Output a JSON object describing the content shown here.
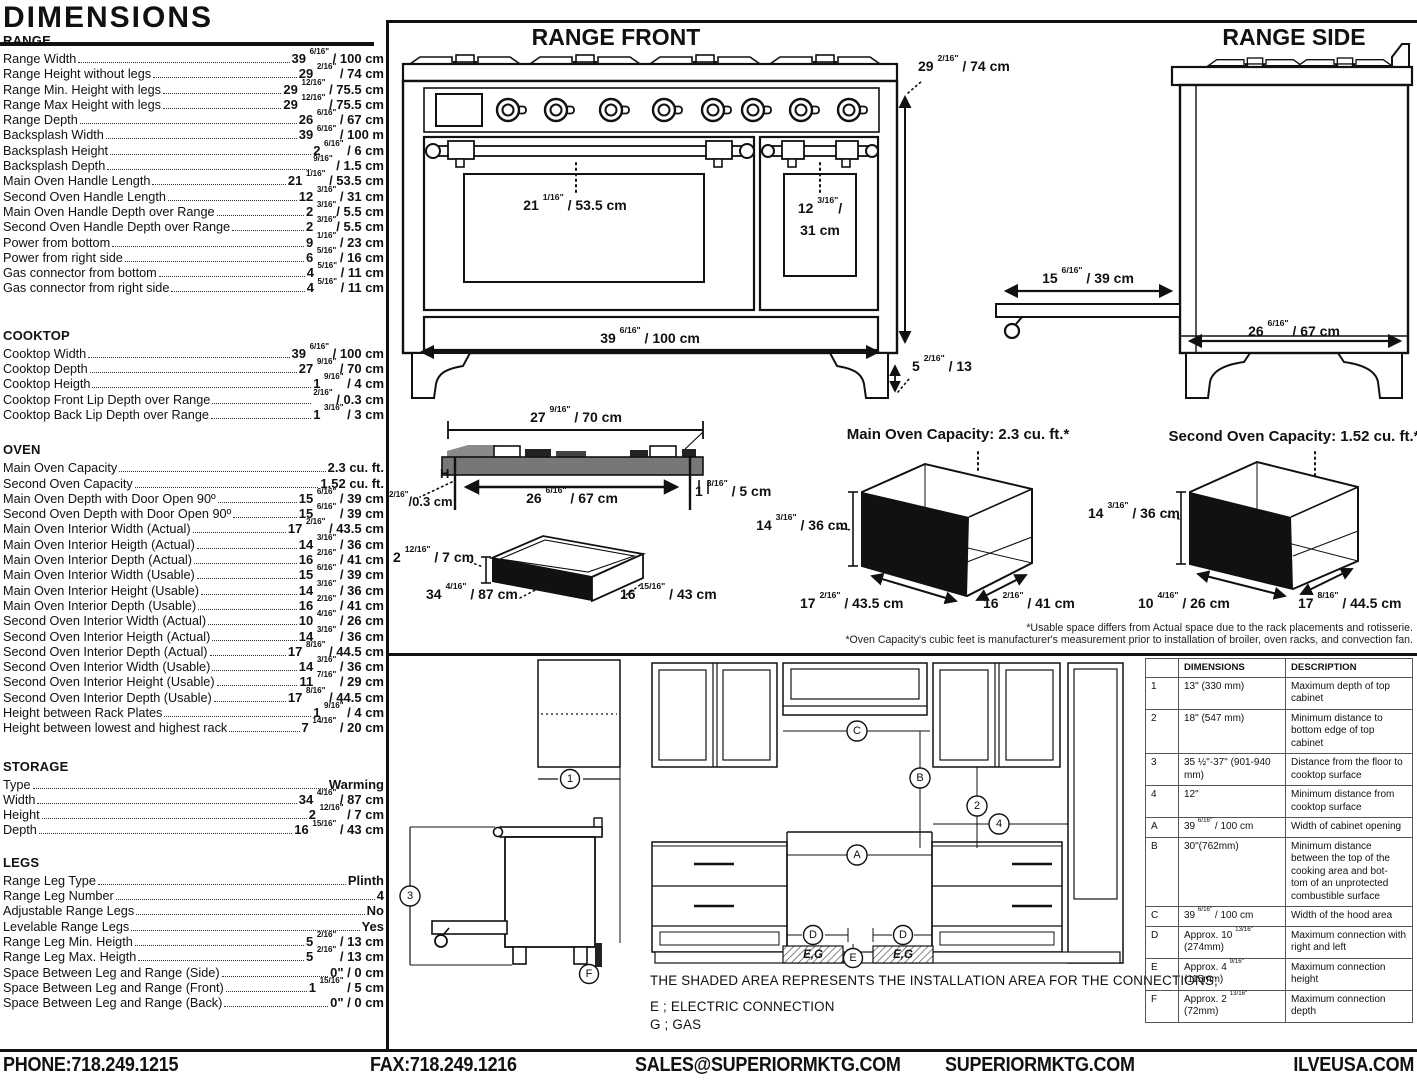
{
  "title": "DIMENSIONS",
  "specs": {
    "sections": [
      {
        "heading": "RANGE",
        "rows": [
          {
            "label": "Range Width",
            "value": "39 6/16\" / 100 cm"
          },
          {
            "label": "Range Height without legs",
            "value": "29 2/16\" / 74 cm"
          },
          {
            "label": "Range Min. Height with legs",
            "value": "29 12/16\" / 75.5 cm"
          },
          {
            "label": "Range Max Height with legs",
            "value": "29 12/16\" / 75.5 cm"
          },
          {
            "label": "Range Depth",
            "value": "26 6/16\" / 67 cm"
          },
          {
            "label": "Backsplash Width",
            "value": "39 6/16\" / 100 m"
          },
          {
            "label": "Backsplash Height",
            "value": "2 6/16\" / 6 cm"
          },
          {
            "label": "Backsplash Depth",
            "value": "9/16\" / 1.5 cm"
          },
          {
            "label": "Main Oven Handle Length",
            "value": "21 1/16\" / 53.5 cm"
          },
          {
            "label": "Second Oven Handle Length",
            "value": "12 3/16\" / 31 cm"
          },
          {
            "label": "Main Oven Handle Depth over Range",
            "value": "2 3/16\"/ 5.5 cm"
          },
          {
            "label": "Second Oven Handle Depth over Range",
            "value": "2 3/16\"/ 5.5 cm"
          },
          {
            "label": "Power from bottom",
            "value": "9 1/16\" / 23 cm"
          },
          {
            "label": "Power from right side",
            "value": "6 5/16\" / 16 cm"
          },
          {
            "label": "Gas connector from bottom",
            "value": "4 5/16\" / 11 cm"
          },
          {
            "label": "Gas connector from right side",
            "value": "4 5/16\" / 11 cm"
          }
        ]
      },
      {
        "heading": "COOKTOP",
        "rows": [
          {
            "label": "Cooktop Width",
            "value": "39 6/16\" / 100 cm"
          },
          {
            "label": "Cooktop Depth",
            "value": "27 9/16\" / 70 cm"
          },
          {
            "label": "Cooktop Heigth",
            "value": "1 9/16\" / 4 cm"
          },
          {
            "label": "Cooktop Front Lip Depth over Range",
            "value": "2/16\" / 0.3 cm"
          },
          {
            "label": "Cooktop Back Lip Depth over Range",
            "value": "1 3/16\" / 3 cm"
          }
        ]
      },
      {
        "heading": "OVEN",
        "rows": [
          {
            "label": "Main Oven Capacity",
            "value": "2.3 cu. ft."
          },
          {
            "label": "Second Oven Capacity",
            "value": "1.52 cu. ft."
          },
          {
            "label": "Main Oven Depth with Door Open 90º",
            "value": "15 6/16\" / 39 cm"
          },
          {
            "label": "Second Oven Depth with Door Open 90º",
            "value": "15 6/16\" / 39 cm"
          },
          {
            "label": "Main Oven Interior Width (Actual)",
            "value": "17 2/16\" / 43.5 cm"
          },
          {
            "label": "Main Oven Interior Heigth (Actual)",
            "value": "14 3/16\" / 36 cm"
          },
          {
            "label": "Main Oven Interior Depth (Actual)",
            "value": "16 2/16\" / 41 cm"
          },
          {
            "label": "Main Oven Interior Width (Usable)",
            "value": "15 6/16\" / 39 cm"
          },
          {
            "label": "Main Oven Interior Height (Usable)",
            "value": "14 3/16\" / 36 cm"
          },
          {
            "label": "Main Oven Interior Depth (Usable)",
            "value": "16 2/16\" / 41 cm"
          },
          {
            "label": "Second Oven Interior Width (Actual)",
            "value": "10 4/16\" / 26 cm"
          },
          {
            "label": "Second Oven Interior Heigth (Actual)",
            "value": "14 3/16\" / 36 cm"
          },
          {
            "label": "Second Oven Interior Depth (Actual)",
            "value": "17 8/16\" / 44.5 cm"
          },
          {
            "label": "Second Oven Interior Width (Usable)",
            "value": "14 3/16\" / 36 cm"
          },
          {
            "label": "Second Oven Interior Height (Usable)",
            "value": "11 7/16\" / 29 cm"
          },
          {
            "label": "Second Oven Interior Depth (Usable)",
            "value": "17 8/16\" / 44.5 cm"
          },
          {
            "label": "Height between Rack Plates",
            "value": "1 9/16\" / 4 cm"
          },
          {
            "label": "Height between lowest and highest rack",
            "value": "7 14/16\" / 20 cm"
          }
        ]
      },
      {
        "heading": "STORAGE",
        "rows": [
          {
            "label": "Type",
            "value": "Warming"
          },
          {
            "label": "Width",
            "value": "34 4/16\" / 87 cm"
          },
          {
            "label": "Height",
            "value": "2 12/16\" / 7 cm"
          },
          {
            "label": "Depth",
            "value": "16 15/16\" / 43 cm"
          }
        ]
      },
      {
        "heading": "LEGS",
        "rows": [
          {
            "label": "Range Leg Type",
            "value": "Plinth"
          },
          {
            "label": "Range Leg Number",
            "value": "4"
          },
          {
            "label": "Adjustable Range Legs",
            "value": "No"
          },
          {
            "label": "Levelable Range Legs",
            "value": "Yes"
          },
          {
            "label": "Range Leg Min. Heigth",
            "value": "5 2/16\" / 13 cm"
          },
          {
            "label": "Range Leg Max. Heigth",
            "value": "5 2/16\" / 13 cm"
          },
          {
            "label": "Space Between Leg and Range (Side)",
            "value": "0\" / 0 cm"
          },
          {
            "label": "Space Between Leg and Range (Front)",
            "value": "1 15/16\" / 5 cm"
          },
          {
            "label": "Space Between Leg and Range (Back)",
            "value": "0\" / 0 cm"
          }
        ]
      }
    ]
  },
  "drawings": {
    "front": {
      "title": "RANGE FRONT",
      "main_handle": "21 1/16\" / 53.5 cm",
      "second_handle": "12 3/16\"/\n31 cm",
      "width": "39 6/16\" / 100 cm",
      "height": "29 2/16\" / 74 cm",
      "leg_height": "5 2/16\" / 13"
    },
    "side": {
      "title": "RANGE SIDE",
      "handle_depth": "15 6/16\" / 39 cm",
      "depth": "26 6/16\" / 67 cm"
    },
    "cooktop": {
      "width": "27 9/16\" / 70 cm",
      "inner_width": "26 6/16\" / 67 cm",
      "back_lip": "1 3/16\" / 5 cm",
      "h": "H",
      "front_lip": "2/16\"/0.3 cm"
    },
    "storage": {
      "height": "2 12/16\" / 7 cm",
      "width": "34 4/16\" / 87 cm",
      "depth": "16 15/16\" / 43 cm"
    },
    "main_oven": {
      "title": "Main Oven Capacity: 2.3 cu. ft.*",
      "height": "14 3/16\" / 36 cm",
      "width": "17 2/16\" / 43.5 cm",
      "depth": "16 2/16\" / 41 cm"
    },
    "second_oven": {
      "title": "Second Oven Capacity: 1.52 cu. ft.*",
      "height": "14 3/16\" / 36 cm",
      "width": "10 4/16\" / 26 cm",
      "depth": "17 8/16\" / 44.5 cm"
    },
    "footnotes": [
      "*Usable space differs from Actual space due to the rack placements and rotisserie.",
      "*Oven Capacity's cubic feet is manufacturer's measurement prior to installation of broiler, oven racks, and convection fan."
    ]
  },
  "installation": {
    "note": "THE SHADED AREA REPRESENTS THE INSTALLATION AREA FOR THE CONNECTIONS;",
    "legend_e": "E ; ELECTRIC CONNECTION",
    "legend_g": "G ; GAS",
    "eg": "E,G",
    "callouts": {
      "n1": "1",
      "n2": "2",
      "n3": "3",
      "n4": "4",
      "A": "A",
      "B": "B",
      "C": "C",
      "D": "D",
      "E": "E",
      "F": "F"
    }
  },
  "table": {
    "headers": [
      "",
      "DIMENSIONS",
      "DESCRIPTION"
    ],
    "rows": [
      {
        "id": "1",
        "dims": "13\" (330 mm)",
        "desc": "Maximum depth of top cabinet"
      },
      {
        "id": "2",
        "dims": "18\" (547 mm)",
        "desc": "Minimum distance to bottom edge of top cabinet"
      },
      {
        "id": "3",
        "dims": "35 ½\"-37\" (901-940 mm)",
        "desc": "Distance from the floor to cooktop surface"
      },
      {
        "id": "4",
        "dims": "12\"",
        "desc": "Minimum distance from cooktop surface"
      },
      {
        "id": "A",
        "dims": "39 6/16\" / 100 cm",
        "desc": "Width of cabinet opening"
      },
      {
        "id": "B",
        "dims": "30\"(762mm)",
        "desc": "Minimum distance between the top of the cooking area and bot- tom of an unprotected combustible surface"
      },
      {
        "id": "C",
        "dims": "39 6/16\" / 100 cm",
        "desc": "Width of the hood area"
      },
      {
        "id": "D",
        "dims": "Approx. 10 13/16\" (274mm)",
        "desc": "Maximum connection with right and left"
      },
      {
        "id": "E",
        "dims": "Approx. 4 9/16\" (115mm)",
        "desc": "Maximum connection height"
      },
      {
        "id": "F",
        "dims": "Approx. 2 13/16\" (72mm)",
        "desc": "Maximum connection depth"
      }
    ]
  },
  "footer": {
    "phone": "PHONE:718.249.1215",
    "fax": "FAX:718.249.1216",
    "email": "SALES@SUPERIORMKTG.COM",
    "site": "SUPERIORMKTG.COM",
    "site2": "ILVEUSA.COM"
  }
}
